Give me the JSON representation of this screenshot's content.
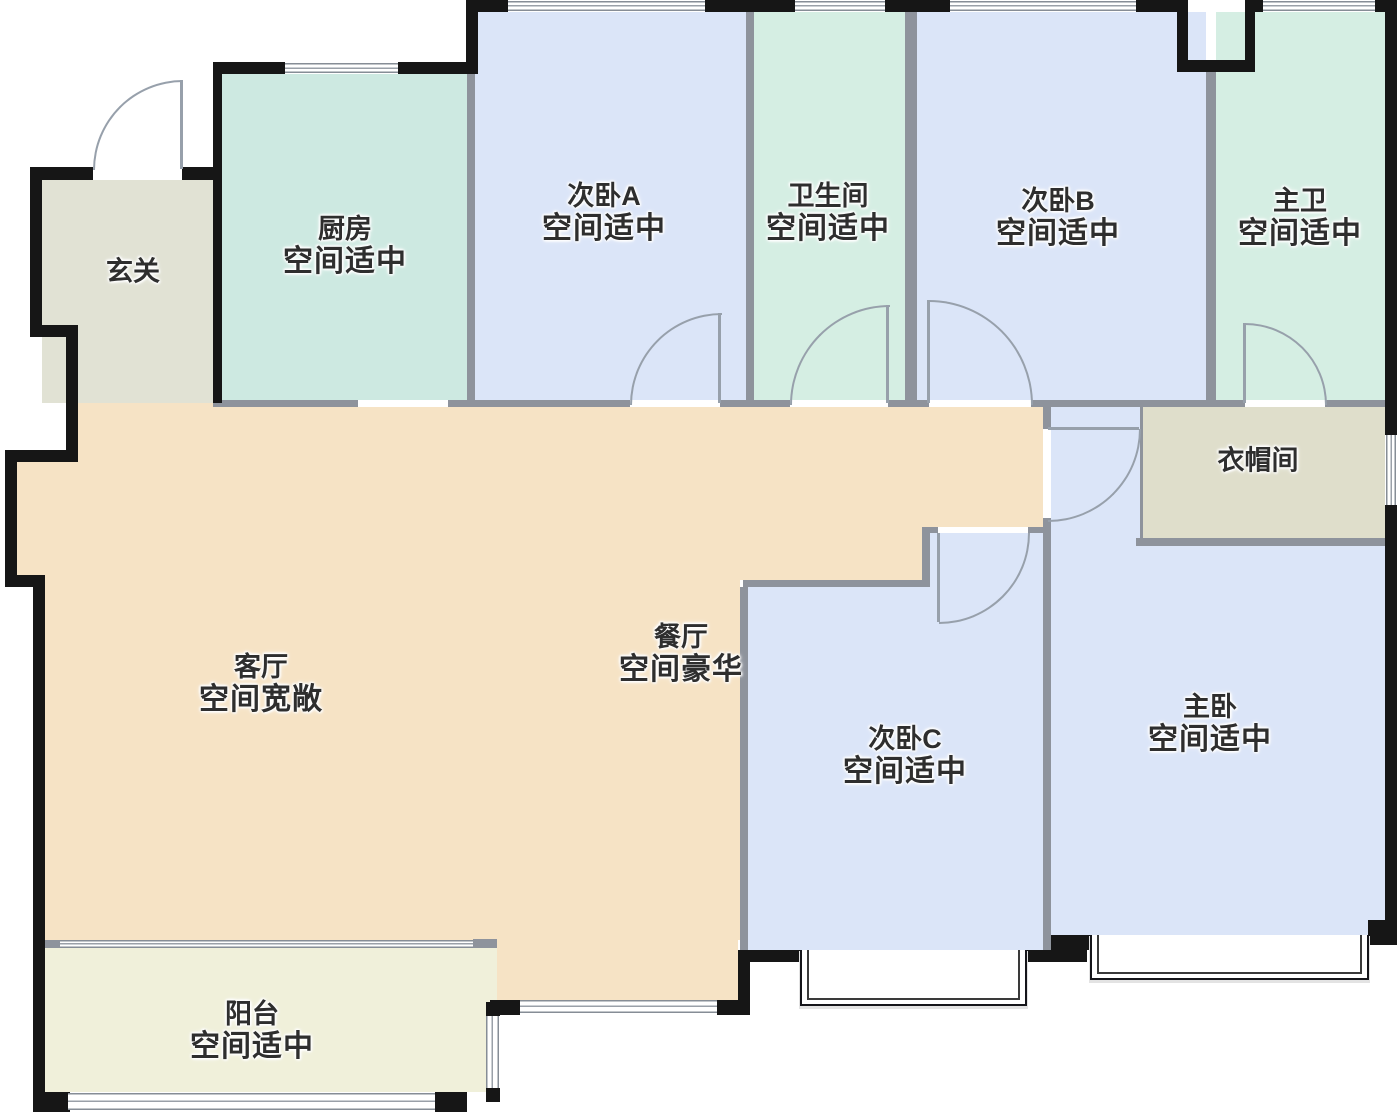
{
  "plan_title": "户型图",
  "colors": {
    "exterior_wall": "#161616",
    "interior_wall": "#8e939c",
    "entry_fill": "#e1e2d4",
    "kitchen_fill": "#cde9e1",
    "bedroom_fill": "#dbe5f8",
    "bathroom_fill": "#d5eee3",
    "living_fill": "#f6e3c5",
    "closet_fill": "#dfdecb",
    "balcony_fill": "#f0f0da",
    "door_arc": "#97a0ab",
    "label_text": "#2e2e2e"
  },
  "rooms": {
    "entry": {
      "name": "玄关",
      "note": ""
    },
    "kitchen": {
      "name": "厨房",
      "note": "空间适中"
    },
    "bedroomA": {
      "name": "次卧A",
      "note": "空间适中"
    },
    "bathroom": {
      "name": "卫生间",
      "note": "空间适中"
    },
    "bedroomB": {
      "name": "次卧B",
      "note": "空间适中"
    },
    "masterBath": {
      "name": "主卫",
      "note": "空间适中"
    },
    "closet": {
      "name": "衣帽间",
      "note": ""
    },
    "living": {
      "name": "客厅",
      "note": "空间宽敞"
    },
    "dining": {
      "name": "餐厅",
      "note": "空间豪华"
    },
    "bedroomC": {
      "name": "次卧C",
      "note": "空间适中"
    },
    "master": {
      "name": "主卧",
      "note": "空间适中"
    },
    "balcony": {
      "name": "阳台",
      "note": "空间适中"
    }
  }
}
